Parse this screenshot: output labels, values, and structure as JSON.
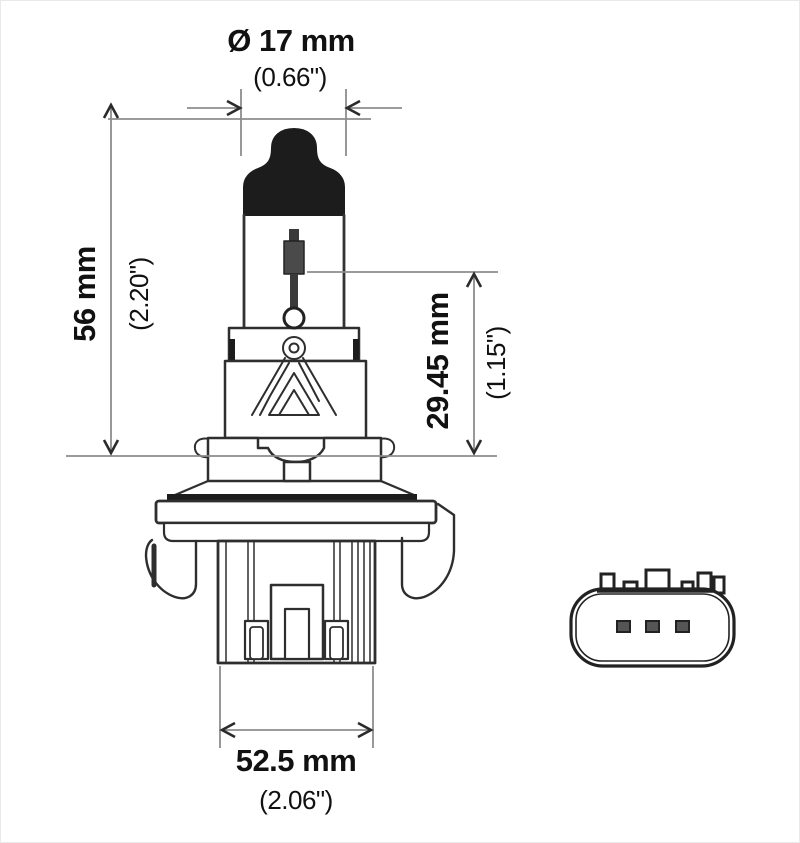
{
  "diagram": {
    "labels": {
      "top": {
        "metric": "Ø 17 mm",
        "imperial": "(0.66\")"
      },
      "left": {
        "metric": "56 mm",
        "imperial": "(2.20\")"
      },
      "right": {
        "metric": "29.45 mm",
        "imperial": "(1.15\")"
      },
      "bottom": {
        "metric": "52.5 mm",
        "imperial": "(2.06\")"
      }
    },
    "colors": {
      "background": "#ffffff",
      "outline": "#2e2e2e",
      "dark_fill": "#1c1c1c",
      "dimension_line": "#8d8d8d",
      "arrowhead": "#2b2b2b",
      "text": "#111111"
    }
  }
}
